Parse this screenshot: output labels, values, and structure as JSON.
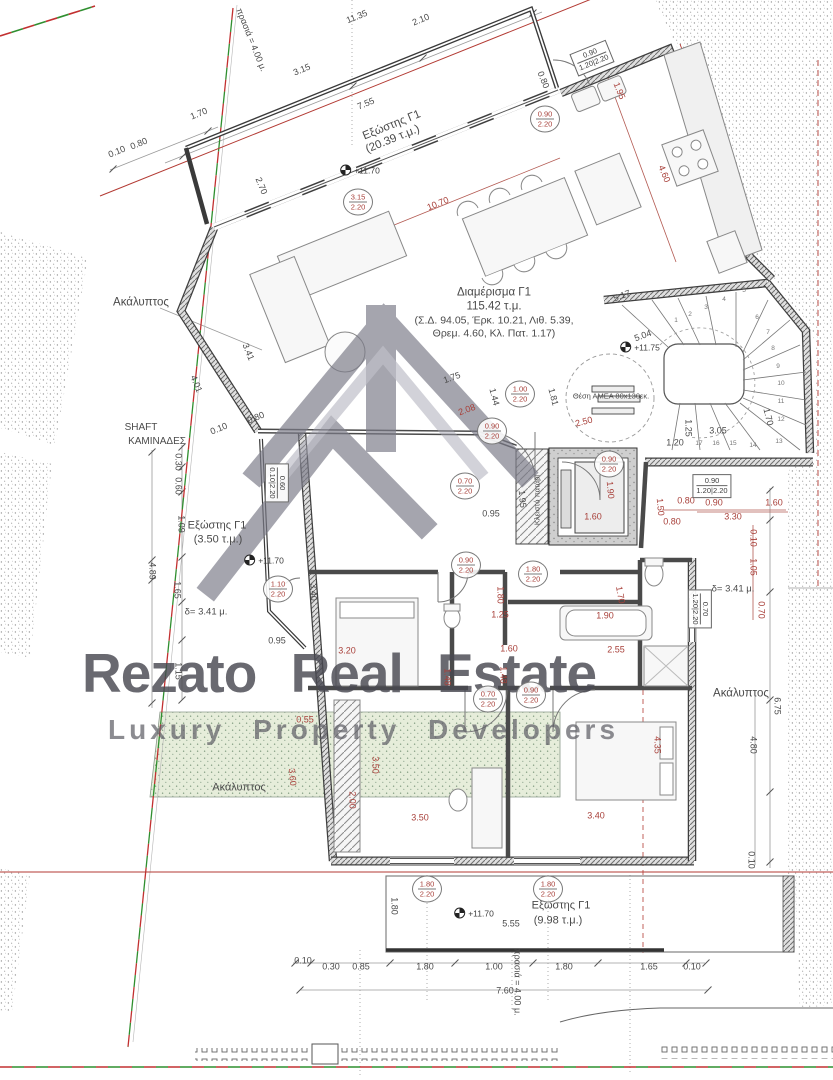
{
  "watermark": {
    "brand": "Rezato  Real Estate",
    "tagline": "Luxury  Property  Developers"
  },
  "apartment": {
    "name": "Διαμέρισμα Γ1",
    "area": "115.42 τ.μ.",
    "factors_line1": "(Σ.Δ. 94.05, Έρκ. 10.21, Λιθ. 5.39,",
    "factors_line2": "Θρεμ. 4.60, Κλ. Πατ. 1.17)"
  },
  "colors": {
    "dim_red": "#a8403a",
    "dim_gray": "#4a4a4a",
    "boundary_red": "#c23030",
    "boundary_green": "#2f8f2f",
    "wall": "#3f3f3f",
    "watermark_gray": "#7b7b88"
  },
  "annotations": [
    {
      "n": "area-label-akalyptos-left",
      "t": "Ακάλυπτος",
      "x": 141,
      "y": 303,
      "s": 11.5
    },
    {
      "n": "shaft-label-line1",
      "t": "SHAFT",
      "x": 141,
      "y": 428,
      "s": 10
    },
    {
      "n": "shaft-label-line2",
      "t": "ΚΑΜΙΝΑΔΕΣ",
      "x": 157,
      "y": 442,
      "s": 10
    },
    {
      "n": "balcony-left-label",
      "t": "Εξώστης Γ1",
      "x": 217,
      "y": 526,
      "s": 11
    },
    {
      "n": "balcony-left-area",
      "t": "(3.50 τ.μ.)",
      "x": 218,
      "y": 540,
      "s": 11
    },
    {
      "n": "setback-delta-left",
      "t": "δ= 3.41 μ.",
      "x": 206,
      "y": 612,
      "s": 9.5
    },
    {
      "n": "setback-delta-right",
      "t": "δ= 3.41 μ.",
      "x": 733,
      "y": 589,
      "s": 9.5
    },
    {
      "n": "area-label-akalyptos-right",
      "t": "Ακάλυπτος",
      "x": 741,
      "y": 694,
      "s": 11.5
    },
    {
      "n": "area-label-akalyptos-bottom",
      "t": "Ακάλυπτος",
      "x": 239,
      "y": 788,
      "s": 11
    },
    {
      "n": "balcony-top-label",
      "t": "Εξώστης Γ1",
      "x": 392,
      "y": 126,
      "r": -22,
      "s": 11.5
    },
    {
      "n": "balcony-top-area",
      "t": "(20.39 τ.μ.)",
      "x": 393,
      "y": 140,
      "r": -22,
      "s": 11.5
    },
    {
      "n": "balcony-bottom-label",
      "t": "Εξώστης Γ1",
      "x": 561,
      "y": 906,
      "s": 11
    },
    {
      "n": "balcony-bottom-area",
      "t": "(9.98 τ.μ.)",
      "x": 558,
      "y": 921,
      "s": 11
    },
    {
      "n": "setback-note-top",
      "t": "πρασιά = 4.00 μ.",
      "x": 251,
      "y": 40,
      "r": 68,
      "s": 9
    },
    {
      "n": "setback-note-bottom",
      "t": "πρασιά = 4.00 μ.",
      "x": 517,
      "y": 982,
      "r": 90,
      "s": 9
    },
    {
      "n": "amea-note",
      "t": "Θέση ΑΜΕΑ 80x130εκ.",
      "x": 611,
      "y": 396,
      "s": 7.5
    },
    {
      "n": "patari-note",
      "t": "Κλειστό πατάρι",
      "x": 537,
      "y": 500,
      "r": -90,
      "s": 7.5
    },
    {
      "n": "dim",
      "t": "11.35",
      "x": 357,
      "y": 17,
      "r": -22
    },
    {
      "n": "dim",
      "t": "2.10",
      "x": 421,
      "y": 20,
      "r": -22
    },
    {
      "n": "dim",
      "t": "3.15",
      "x": 302,
      "y": 70,
      "r": -22
    },
    {
      "n": "dim",
      "t": "7.55",
      "x": 366,
      "y": 104,
      "r": -22
    },
    {
      "n": "dim",
      "t": "1.70",
      "x": 199,
      "y": 114,
      "r": -22
    },
    {
      "n": "dim",
      "t": "0.10",
      "x": 117,
      "y": 152,
      "r": -22
    },
    {
      "n": "dim",
      "t": "0.80",
      "x": 139,
      "y": 144,
      "r": -22
    },
    {
      "n": "dim",
      "t": "2.70",
      "x": 261,
      "y": 186,
      "r": 68
    },
    {
      "n": "dim",
      "t": "0.80",
      "x": 543,
      "y": 80,
      "r": 68
    },
    {
      "n": "dim",
      "t": "5.17",
      "x": 622,
      "y": 296,
      "r": -20
    },
    {
      "n": "dim",
      "t": "5.04",
      "x": 643,
      "y": 336,
      "r": -20
    },
    {
      "n": "dim",
      "t": "3.41",
      "x": 248,
      "y": 352,
      "r": 68
    },
    {
      "n": "dim",
      "t": "4.01",
      "x": 196,
      "y": 384,
      "r": 68
    },
    {
      "n": "dim",
      "t": "1.44",
      "x": 494,
      "y": 397,
      "r": 75
    },
    {
      "n": "dim",
      "t": "1.81",
      "x": 553,
      "y": 397,
      "r": 75
    },
    {
      "n": "dim",
      "t": "1.75",
      "x": 452,
      "y": 378,
      "r": -20
    },
    {
      "n": "dim",
      "t": "0.10",
      "x": 219,
      "y": 429,
      "r": -22
    },
    {
      "n": "dim",
      "t": "0.80",
      "x": 256,
      "y": 418,
      "r": -22
    },
    {
      "n": "dim",
      "t": "0.30",
      "x": 178,
      "y": 462,
      "r": 90
    },
    {
      "n": "dim",
      "t": "0.60",
      "x": 178,
      "y": 486,
      "r": 90
    },
    {
      "n": "dim",
      "t": "1.09",
      "x": 181,
      "y": 524,
      "r": 90
    },
    {
      "n": "dim",
      "t": "4.89",
      "x": 152,
      "y": 571,
      "r": 90
    },
    {
      "n": "dim",
      "t": "1.65",
      "x": 177,
      "y": 590,
      "r": 90
    },
    {
      "n": "dim",
      "t": "1.15",
      "x": 178,
      "y": 671,
      "r": 90
    },
    {
      "n": "dim",
      "t": "0.95",
      "x": 277,
      "y": 641
    },
    {
      "n": "dim",
      "t": "0.95",
      "x": 491,
      "y": 514
    },
    {
      "n": "dim",
      "t": "1.95",
      "x": 522,
      "y": 499,
      "r": 85
    },
    {
      "n": "dim",
      "t": "3.40",
      "x": 313,
      "y": 592,
      "r": 90
    },
    {
      "n": "dim",
      "t": "1.20",
      "x": 675,
      "y": 443
    },
    {
      "n": "dim",
      "t": "3.05",
      "x": 718,
      "y": 431
    },
    {
      "n": "dim",
      "t": "1.25",
      "x": 688,
      "y": 428,
      "r": 90
    },
    {
      "n": "dim",
      "t": "1.70",
      "x": 768,
      "y": 417,
      "r": 75
    },
    {
      "n": "dim",
      "t": "0.10",
      "x": 303,
      "y": 961
    },
    {
      "n": "dim",
      "t": "0.30",
      "x": 331,
      "y": 967
    },
    {
      "n": "dim",
      "t": "0.85",
      "x": 361,
      "y": 967
    },
    {
      "n": "dim",
      "t": "1.80",
      "x": 425,
      "y": 967
    },
    {
      "n": "dim",
      "t": "1.00",
      "x": 494,
      "y": 967
    },
    {
      "n": "dim",
      "t": "1.80",
      "x": 564,
      "y": 967
    },
    {
      "n": "dim",
      "t": "1.65",
      "x": 649,
      "y": 967
    },
    {
      "n": "dim",
      "t": "0.10",
      "x": 692,
      "y": 967
    },
    {
      "n": "dim",
      "t": "7.60",
      "x": 505,
      "y": 991
    },
    {
      "n": "dim",
      "t": "1.80",
      "x": 394,
      "y": 906,
      "r": 90
    },
    {
      "n": "dim",
      "t": "5.55",
      "x": 511,
      "y": 924
    },
    {
      "n": "dim",
      "t": "6.75",
      "x": 777,
      "y": 706,
      "r": 90
    },
    {
      "n": "dim",
      "t": "4.80",
      "x": 753,
      "y": 745,
      "r": 90
    },
    {
      "n": "dim",
      "t": "0.10",
      "x": 751,
      "y": 860,
      "r": 90
    },
    {
      "n": "dim",
      "t": "10.70",
      "x": 438,
      "y": 204,
      "r": -22,
      "c": "r"
    },
    {
      "n": "dim",
      "t": "4.60",
      "x": 664,
      "y": 174,
      "r": 68,
      "c": "r"
    },
    {
      "n": "dim",
      "t": "1.95",
      "x": 619,
      "y": 91,
      "r": 68,
      "c": "r"
    },
    {
      "n": "dim",
      "t": "2.50",
      "x": 584,
      "y": 422,
      "r": -15,
      "c": "r"
    },
    {
      "n": "dim",
      "t": "2.08",
      "x": 467,
      "y": 410,
      "r": -20,
      "c": "r"
    },
    {
      "n": "dim",
      "t": "1.90",
      "x": 610,
      "y": 490,
      "r": 85,
      "c": "r"
    },
    {
      "n": "dim",
      "t": "1.60",
      "x": 593,
      "y": 517,
      "c": "r"
    },
    {
      "n": "dim",
      "t": "1.50",
      "x": 660,
      "y": 507,
      "r": 85,
      "c": "r"
    },
    {
      "n": "dim",
      "t": "0.80",
      "x": 686,
      "y": 501,
      "c": "r"
    },
    {
      "n": "dim",
      "t": "0.90",
      "x": 714,
      "y": 503,
      "c": "r"
    },
    {
      "n": "dim",
      "t": "1.60",
      "x": 774,
      "y": 503,
      "c": "r"
    },
    {
      "n": "dim",
      "t": "3.30",
      "x": 733,
      "y": 517,
      "c": "r"
    },
    {
      "n": "dim",
      "t": "0.80",
      "x": 672,
      "y": 522,
      "c": "r"
    },
    {
      "n": "dim",
      "t": "0.10",
      "x": 753,
      "y": 538,
      "r": 90,
      "c": "r"
    },
    {
      "n": "dim",
      "t": "1.05",
      "x": 753,
      "y": 567,
      "r": 90,
      "c": "r"
    },
    {
      "n": "dim",
      "t": "0.70",
      "x": 761,
      "y": 610,
      "r": 90,
      "c": "r"
    },
    {
      "n": "dim",
      "t": "1.80",
      "x": 500,
      "y": 595,
      "r": 90,
      "c": "r"
    },
    {
      "n": "dim",
      "t": "1.25",
      "x": 500,
      "y": 615,
      "c": "r"
    },
    {
      "n": "dim",
      "t": "1.90",
      "x": 605,
      "y": 616,
      "c": "r"
    },
    {
      "n": "dim",
      "t": "1.70",
      "x": 620,
      "y": 595,
      "r": 80,
      "c": "r"
    },
    {
      "n": "dim",
      "t": "1.60",
      "x": 509,
      "y": 649,
      "c": "r"
    },
    {
      "n": "dim",
      "t": "1.48",
      "x": 503,
      "y": 675,
      "r": 90,
      "c": "r"
    },
    {
      "n": "dim",
      "t": "2.55",
      "x": 616,
      "y": 650,
      "c": "r"
    },
    {
      "n": "dim",
      "t": "3.20",
      "x": 347,
      "y": 651,
      "c": "r"
    },
    {
      "n": "dim",
      "t": "1.48",
      "x": 447,
      "y": 677,
      "r": 90,
      "c": "r"
    },
    {
      "n": "dim",
      "t": "3.40",
      "x": 596,
      "y": 816,
      "c": "r"
    },
    {
      "n": "dim",
      "t": "4.35",
      "x": 657,
      "y": 745,
      "r": 90,
      "c": "r"
    },
    {
      "n": "dim",
      "t": "3.50",
      "x": 375,
      "y": 765,
      "r": 90,
      "c": "r"
    },
    {
      "n": "dim",
      "t": "2.00",
      "x": 352,
      "y": 800,
      "r": 90,
      "c": "r"
    },
    {
      "n": "dim",
      "t": "3.50",
      "x": 420,
      "y": 818,
      "c": "r"
    },
    {
      "n": "dim",
      "t": "3.60",
      "x": 292,
      "y": 777,
      "r": 85,
      "c": "r"
    },
    {
      "n": "dim",
      "t": "0.55",
      "x": 305,
      "y": 720,
      "c": "r"
    }
  ],
  "badges": [
    {
      "top": "0.90",
      "bottom": "2.20",
      "x": 545,
      "y": 119
    },
    {
      "top": "3.15",
      "bottom": "2.20",
      "x": 358,
      "y": 202
    },
    {
      "top": "1.00",
      "bottom": "2.20",
      "x": 520,
      "y": 394
    },
    {
      "top": "0.90",
      "bottom": "2.20",
      "x": 492,
      "y": 431
    },
    {
      "top": "0.90",
      "bottom": "2.20",
      "x": 609,
      "y": 464
    },
    {
      "top": "0.70",
      "bottom": "2.20",
      "x": 465,
      "y": 486
    },
    {
      "top": "0.90",
      "bottom": "2.20",
      "x": 466,
      "y": 565
    },
    {
      "top": "1.80",
      "bottom": "2.20",
      "x": 533,
      "y": 574
    },
    {
      "top": "1.10",
      "bottom": "2.20",
      "x": 278,
      "y": 589
    },
    {
      "top": "0.70",
      "bottom": "2.20",
      "x": 488,
      "y": 699
    },
    {
      "top": "0.90",
      "bottom": "2.20",
      "x": 531,
      "y": 695
    },
    {
      "top": "1.80",
      "bottom": "2.20",
      "x": 427,
      "y": 889
    },
    {
      "top": "1.80",
      "bottom": "2.20",
      "x": 548,
      "y": 889
    }
  ],
  "boxbadges": [
    {
      "l1": "0.90",
      "l2": "1.20|2.20",
      "x": 592,
      "y": 58,
      "r": -22
    },
    {
      "l1": "0.90",
      "l2": "1.20|2.20",
      "x": 712,
      "y": 486
    },
    {
      "l1": "0.70",
      "l2": "1.20|2.20",
      "x": 700,
      "y": 609,
      "r": 90
    },
    {
      "l1": "0.60",
      "l2": "0.10|2.20",
      "x": 277,
      "y": 483,
      "r": 90
    }
  ],
  "levels": [
    {
      "t": "+11.75",
      "x": 640,
      "y": 347
    },
    {
      "t": "+11.70",
      "x": 360,
      "y": 170
    },
    {
      "t": "+11.70",
      "x": 264,
      "y": 560
    },
    {
      "t": "+11.70",
      "x": 474,
      "y": 913
    }
  ],
  "stair_steps": [
    {
      "t": "1",
      "x": 676,
      "y": 321
    },
    {
      "t": "2",
      "x": 690,
      "y": 315
    },
    {
      "t": "3",
      "x": 706,
      "y": 308
    },
    {
      "t": "4",
      "x": 724,
      "y": 300
    },
    {
      "t": "5",
      "x": 744,
      "y": 291
    },
    {
      "t": "6",
      "x": 757,
      "y": 318
    },
    {
      "t": "7",
      "x": 768,
      "y": 333
    },
    {
      "t": "8",
      "x": 773,
      "y": 349
    },
    {
      "t": "9",
      "x": 778,
      "y": 367
    },
    {
      "t": "10",
      "x": 781,
      "y": 384
    },
    {
      "t": "11",
      "x": 781,
      "y": 402
    },
    {
      "t": "12",
      "x": 781,
      "y": 420
    },
    {
      "t": "13",
      "x": 779,
      "y": 442
    },
    {
      "t": "14",
      "x": 753,
      "y": 446
    },
    {
      "t": "15",
      "x": 733,
      "y": 444
    },
    {
      "t": "16",
      "x": 716,
      "y": 444
    },
    {
      "t": "17",
      "x": 699,
      "y": 444
    }
  ]
}
